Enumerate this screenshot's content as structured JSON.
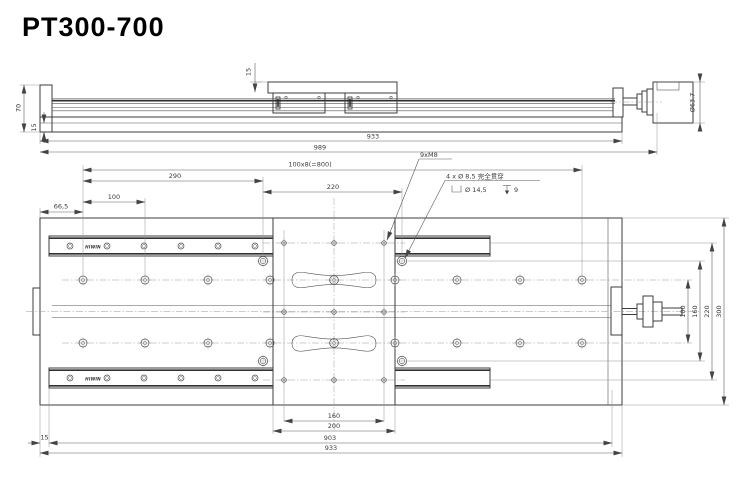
{
  "title": "PT300-700",
  "side_view": {
    "dim_height": "70",
    "dim_base_thickness": "15",
    "dim_carriage_height": "15",
    "dim_body_length": "933",
    "dim_total_length": "989",
    "dim_motor_diameter": "Ø63.7"
  },
  "plan_view": {
    "brand": "HIWIN",
    "dim_hole_pattern": "100x8(=800)",
    "dim_290": "290",
    "dim_220": "220",
    "dim_100_top": "100",
    "dim_left_margin": "66,5",
    "label_m8": "9xM8",
    "label_cb_line1": "4 x Ø 8,5 完全贯穿",
    "label_cb_dia": "Ø 14,5",
    "label_cb_depth": "9",
    "dim_right_100": "100",
    "dim_right_160": "160",
    "dim_right_220": "220",
    "dim_right_300": "300",
    "dim_bottom_160": "160",
    "dim_bottom_200": "200",
    "dim_bottom_903": "903",
    "dim_bottom_933": "933",
    "dim_rail_inset": "15"
  }
}
